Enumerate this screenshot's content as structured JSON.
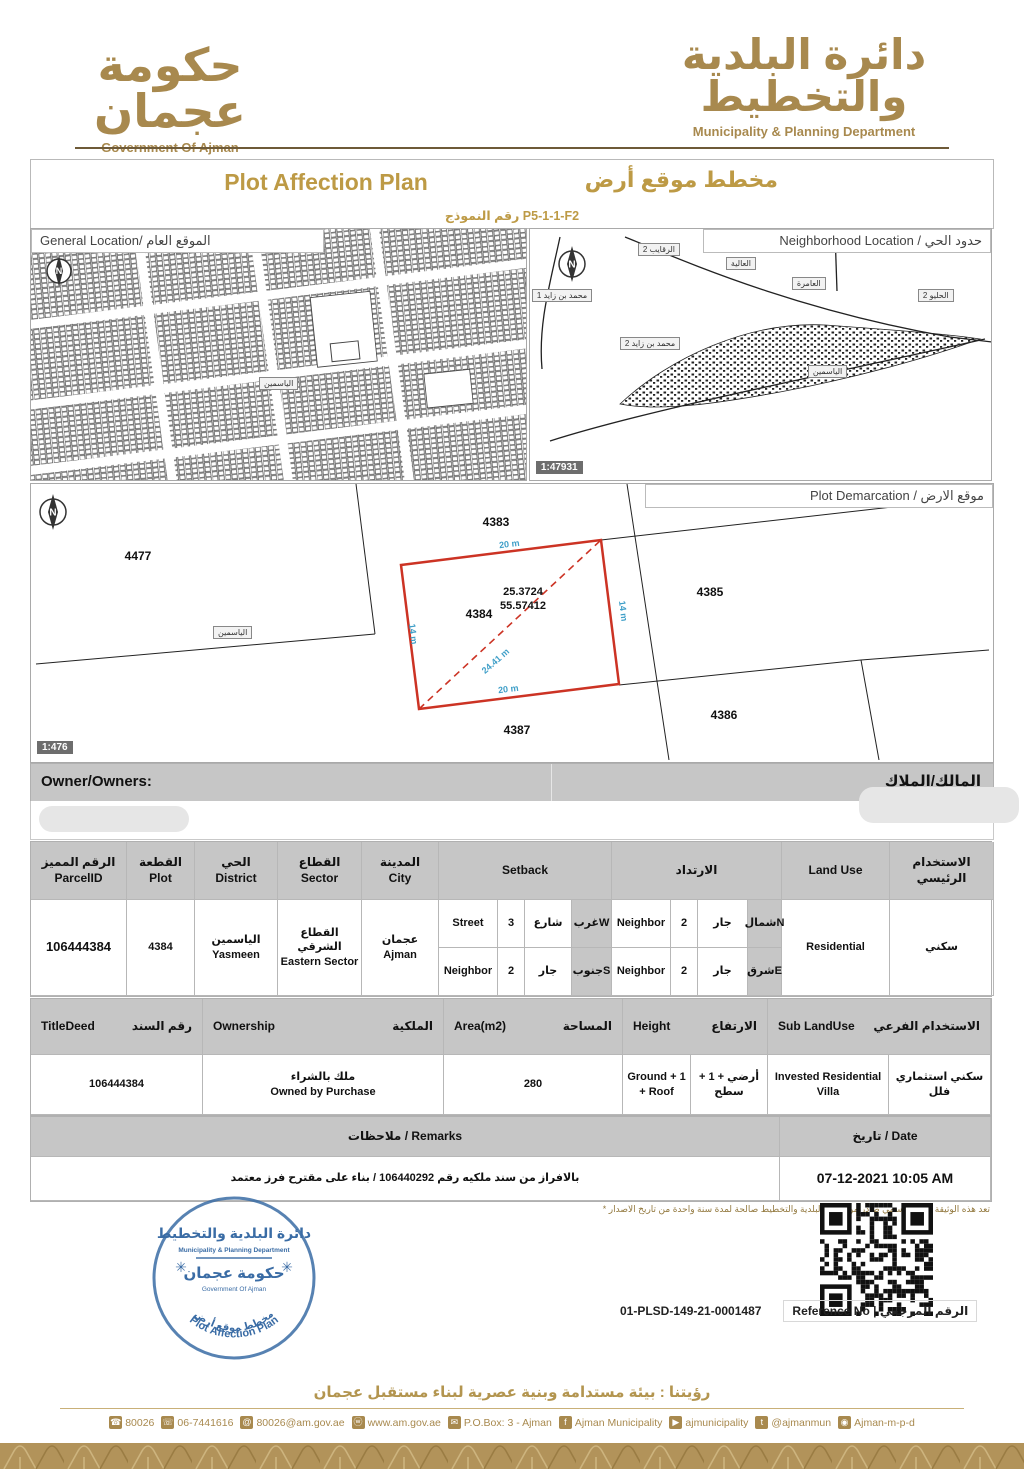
{
  "header": {
    "gov_logo": {
      "ar": "حكومة عجمان",
      "en": "Government Of Ajman"
    },
    "dept_logo": {
      "ar": "دائرة البلدية والتخطيط",
      "en": "Municipality & Planning Department"
    }
  },
  "title": {
    "en": "Plot Affection Plan",
    "ar": "مخطط موقع أرض"
  },
  "form": {
    "line": "رقم النموذج P5-1-1-F2"
  },
  "maps": {
    "general": {
      "title": "General Location/ الموقع العام",
      "chip": "الياسمين"
    },
    "neighborhood": {
      "title": "Neighborhood Location / حدود الحي",
      "scale": "1:47931",
      "chip": "الياسمين",
      "labels": [
        "الرقايب 2",
        "العالية",
        "العامرة",
        "الحليو 2",
        "محمد بن زايد 1",
        "محمد بن زايد 2"
      ]
    },
    "demarcation": {
      "title": "Plot Demarcation / موقع الارض",
      "scale": "1:476",
      "chip": "الياسمين",
      "plot_id": "4384",
      "adjacent": [
        "4477",
        "4383",
        "4385",
        "4386",
        "4387"
      ],
      "dims": {
        "top": "20 m",
        "bottom": "20 m",
        "left": "14 m",
        "right": "14 m",
        "diagonal": "24.41 m"
      },
      "coords": {
        "line1": "25.3724",
        "line2": "55.57412"
      }
    }
  },
  "owner": {
    "en": "Owner/Owners:",
    "ar": "المالك/الملاك"
  },
  "parcel_table": {
    "headers": {
      "parcel_id": {
        "ar": "الرقم المميز",
        "en": "ParcelID"
      },
      "plot": {
        "ar": "القطعة",
        "en": "Plot"
      },
      "district": {
        "ar": "الحي",
        "en": "District"
      },
      "sector": {
        "ar": "القطاع",
        "en": "Sector"
      },
      "city": {
        "ar": "المدينة",
        "en": "City"
      },
      "setback_en": "Setback",
      "setback_ar": "الارتداد",
      "land_use_en": "Land Use",
      "land_use_ar": "الاستخدام الرئيسي"
    },
    "row": {
      "parcel_id": "106444384",
      "plot": "4384",
      "district": {
        "ar": "الياسمين",
        "en": "Yasmeen"
      },
      "sector": {
        "ar": "القطاع الشرقي",
        "en": "Eastern Sector"
      },
      "city": {
        "ar": "عجمان",
        "en": "Ajman"
      },
      "setbacks": [
        {
          "type_en": "Street",
          "value": "3",
          "type_ar": "شارع",
          "dir": "غربW"
        },
        {
          "type_en": "Neighbor",
          "value": "2",
          "type_ar": "جار",
          "dir": "شمالN"
        },
        {
          "type_en": "Neighbor",
          "value": "2",
          "type_ar": "جار",
          "dir": "جنوبS"
        },
        {
          "type_en": "Neighbor",
          "value": "2",
          "type_ar": "جار",
          "dir": "شرقE"
        }
      ],
      "land_use_en": "Residential",
      "land_use_ar": "سكني"
    }
  },
  "deed_table": {
    "headers": {
      "title_deed": {
        "en": "TitleDeed",
        "ar": "رقم السند"
      },
      "ownership": {
        "en": "Ownership",
        "ar": "الملكية"
      },
      "area": {
        "en": "Area(m2)",
        "ar": "المساحة"
      },
      "height": {
        "en": "Height",
        "ar": "الارتفاع"
      },
      "sub_land_use": {
        "en": "Sub LandUse",
        "ar": "الاستخدام الفرعي"
      }
    },
    "row": {
      "title_deed": "106444384",
      "ownership_ar": "ملك بالشراء",
      "ownership_en": "Owned by Purchase",
      "area": "280",
      "height_en": "Ground + 1 + Roof",
      "height_ar": "أرضي + 1 + سطح",
      "sub_land_use_en": "Invested Residential Villa",
      "sub_land_use_ar": "سكني استثماري فلل"
    }
  },
  "remarks": {
    "header_left": "ملاحظات / Remarks",
    "header_right": "تاريخ / Date",
    "remark": "بالافراز من سند ملكيه رقم  106440292 / بناء على مقترح فرز معتمد",
    "date": "07-12-2021 10:05 AM",
    "footnote": "تعد هذه الوثيقة مستند رسمي صادر من دائرة البلدية والتخطيط صالحة لمدة سنة واحدة من تاريخ الاصدار"
  },
  "stamp": {
    "dept_ar": "دائرة البلدية والتخطيط",
    "dept_en": "Municipality & Planning Department",
    "gov_ar": "حكومة عجمان",
    "gov_en": "Government Of Ajman",
    "arc_ar": "مخطط موقع أرض",
    "arc_en": "Plot Affection Plan",
    "rosette": "✳"
  },
  "reference": {
    "value": "01-PLSD-149-21-0001487",
    "label": "Reference No | الرقم المرجعي"
  },
  "footer": {
    "vision": "رؤيتنا : بيئة مستدامة وبنية عصرية لبناء مستقبل عجمان",
    "contacts": [
      {
        "icon": "phone-icon",
        "glyph": "☎",
        "label": "80026"
      },
      {
        "icon": "fax-icon",
        "glyph": "☏",
        "label": "06-7441616"
      },
      {
        "icon": "email-icon",
        "glyph": "@",
        "label": "80026@am.gov.ae"
      },
      {
        "icon": "website-icon",
        "glyph": "ⓦ",
        "label": "www.am.gov.ae"
      },
      {
        "icon": "pobox-icon",
        "glyph": "✉",
        "label": "P.O.Box: 3 - Ajman"
      },
      {
        "icon": "facebook-icon",
        "glyph": "f",
        "label": "Ajman Municipality"
      },
      {
        "icon": "youtube-icon",
        "glyph": "▶",
        "label": "ajmunicipality"
      },
      {
        "icon": "twitter-icon",
        "glyph": "t",
        "label": "@ajmanmun"
      },
      {
        "icon": "instagram-icon",
        "glyph": "◉",
        "label": "Ajman-m-p-d"
      }
    ]
  },
  "colors": {
    "gold": "#a8894e",
    "title_gold": "#bd9a45",
    "stamp_blue": "#3a6ca5",
    "plot_red": "#cc3324",
    "dim_blue": "#3f9fc8",
    "header_gray": "#c6c6c6"
  }
}
